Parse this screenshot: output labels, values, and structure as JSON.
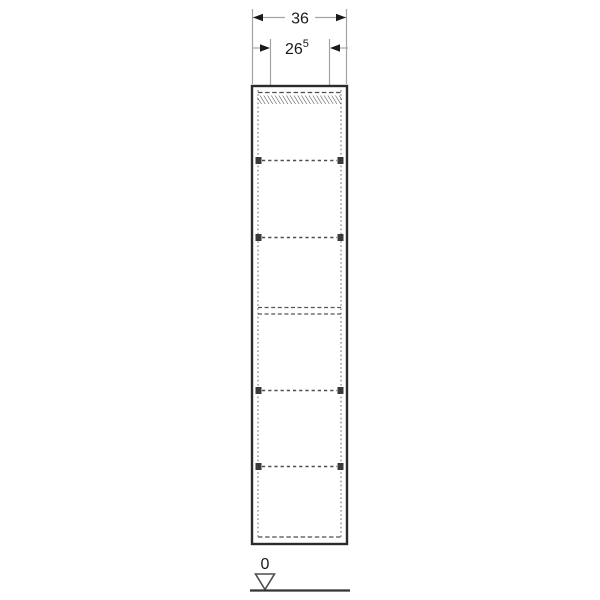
{
  "drawing": {
    "kind": "furniture-technical-drawing",
    "subject": "tall-cabinet-front-elevation",
    "labels": {
      "overall_width": "36",
      "opening_width_value": "26",
      "opening_width_superscript": "5",
      "datum_zero": "0"
    },
    "colors": {
      "background": "#ffffff",
      "cabinet_outline": "#2b2b2b",
      "hidden_edge_dash": "#4d4d4d",
      "dimension_line": "#a3a3a3",
      "arrow_and_text": "#1a1a1a",
      "datum_outline": "#4d4d4d"
    },
    "structure": {
      "adjustable_shelves": 4,
      "fixed_shelves": 1
    }
  }
}
